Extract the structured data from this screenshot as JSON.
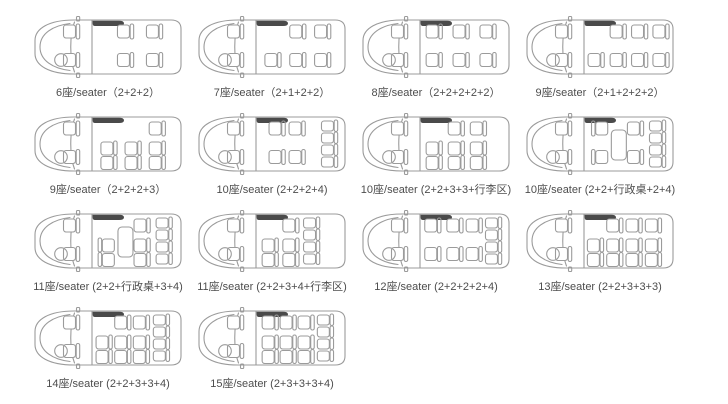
{
  "page": {
    "background": "#ffffff"
  },
  "style": {
    "line_color": "#9b9b9b",
    "dark_accent": "#4a4a4a",
    "label_color": "#4d4d4d"
  },
  "rows": [
    [
      0,
      1,
      2,
      3
    ],
    [
      4,
      5,
      6,
      7
    ],
    [
      8,
      9,
      10,
      11
    ],
    [
      12,
      13
    ]
  ],
  "vans": [
    {
      "seats_total": 6,
      "config": "2+2+2",
      "label": "6座/seater（2+2+2）",
      "layout": {
        "items": [
          {
            "t": "seat",
            "x": 0.34,
            "r": "top"
          },
          {
            "t": "seat",
            "x": 0.34,
            "r": "bottom"
          },
          {
            "t": "seat",
            "x": 0.76,
            "r": "top"
          },
          {
            "t": "seat",
            "x": 0.76,
            "r": "bottom"
          }
        ]
      }
    },
    {
      "seats_total": 7,
      "config": "2+1+2+2",
      "label": "7座/seater（2+1+2+2）",
      "layout": {
        "items": [
          {
            "t": "seat",
            "x": 0.1,
            "r": "bottom"
          },
          {
            "t": "seat",
            "x": 0.46,
            "r": "top"
          },
          {
            "t": "seat",
            "x": 0.46,
            "r": "bottom"
          },
          {
            "t": "seat",
            "x": 0.82,
            "r": "top"
          },
          {
            "t": "seat",
            "x": 0.82,
            "r": "bottom"
          }
        ]
      }
    },
    {
      "seats_total": 8,
      "config": "2+2+2+2+2",
      "label": "8座/seater（2+2+2+2+2）",
      "layout": {
        "items": [
          {
            "t": "seat",
            "x": 0.06,
            "r": "top"
          },
          {
            "t": "seat",
            "x": 0.06,
            "r": "bottom"
          },
          {
            "t": "seat",
            "x": 0.45,
            "r": "top"
          },
          {
            "t": "seat",
            "x": 0.45,
            "r": "bottom"
          },
          {
            "t": "seat",
            "x": 0.84,
            "r": "top"
          },
          {
            "t": "seat",
            "x": 0.84,
            "r": "bottom"
          }
        ]
      }
    },
    {
      "seats_total": 9,
      "config": "2+1+2+2+2",
      "label": "9座/seater（2+1+2+2+2）",
      "layout": {
        "items": [
          {
            "t": "seat",
            "x": 0.03,
            "r": "bottom"
          },
          {
            "t": "seat",
            "x": 0.35,
            "r": "top"
          },
          {
            "t": "seat",
            "x": 0.35,
            "r": "bottom"
          },
          {
            "t": "seat",
            "x": 0.66,
            "r": "top"
          },
          {
            "t": "seat",
            "x": 0.66,
            "r": "bottom"
          },
          {
            "t": "seat",
            "x": 0.97,
            "r": "top"
          },
          {
            "t": "seat",
            "x": 0.97,
            "r": "bottom"
          }
        ]
      }
    },
    {
      "seats_total": 9,
      "config": "2+2+2+3",
      "label": "9座/seater（2+2+2+3）",
      "layout": {
        "items": [
          {
            "t": "bench2",
            "x": 0.1
          },
          {
            "t": "bench2",
            "x": 0.45
          },
          {
            "t": "bench2",
            "x": 0.8
          },
          {
            "t": "seat",
            "x": 0.8,
            "r": "top"
          }
        ]
      }
    },
    {
      "seats_total": 10,
      "config": "2+2+2+4",
      "label": "10座/seater (2+2+2+4)",
      "layout": {
        "items": [
          {
            "t": "seat",
            "x": 0.16,
            "r": "top"
          },
          {
            "t": "seat",
            "x": 0.16,
            "r": "bottom"
          },
          {
            "t": "seat",
            "x": 0.45,
            "r": "top"
          },
          {
            "t": "seat",
            "x": 0.45,
            "r": "bottom"
          },
          {
            "t": "bench4",
            "x": 0.92
          }
        ]
      }
    },
    {
      "seats_total": 10,
      "config": "2+2+3+3+行李区",
      "label": "10座/seater (2+2+3+3+行李区)",
      "layout": {
        "items": [
          {
            "t": "bench2",
            "x": 0.06
          },
          {
            "t": "bench2",
            "x": 0.38
          },
          {
            "t": "seat",
            "x": 0.38,
            "r": "top"
          },
          {
            "t": "bench2",
            "x": 0.7
          },
          {
            "t": "seat",
            "x": 0.7,
            "r": "top"
          }
        ]
      }
    },
    {
      "seats_total": 10,
      "config": "2+2+行政桌+2+4",
      "label": "10座/seater (2+2+行政桌+2+4)",
      "layout": {
        "items": [
          {
            "t": "seat",
            "x": 0.08,
            "r": "top",
            "flip": true
          },
          {
            "t": "seat",
            "x": 0.08,
            "r": "bottom",
            "flip": true
          },
          {
            "t": "table",
            "x": 0.36
          },
          {
            "t": "seat",
            "x": 0.6,
            "r": "top"
          },
          {
            "t": "seat",
            "x": 0.6,
            "r": "bottom"
          },
          {
            "t": "bench4",
            "x": 0.92
          }
        ]
      }
    },
    {
      "seats_total": 11,
      "config": "2+2+行政桌+3+4",
      "label": "11座/seater (2+2+行政桌+3+4)",
      "layout": {
        "items": [
          {
            "t": "bench2",
            "x": 0.06,
            "flip": true
          },
          {
            "t": "table",
            "x": 0.34
          },
          {
            "t": "seat",
            "x": 0.58,
            "r": "top"
          },
          {
            "t": "bench2",
            "x": 0.58
          },
          {
            "t": "bench4",
            "x": 0.9
          }
        ]
      }
    },
    {
      "seats_total": 11,
      "config": "2+2+3+4+行李区",
      "label": "11座/seater (2+2+3+4+行李区)",
      "layout": {
        "items": [
          {
            "t": "bench2",
            "x": 0.06
          },
          {
            "t": "seat",
            "x": 0.36,
            "r": "top"
          },
          {
            "t": "bench2",
            "x": 0.36
          },
          {
            "t": "bench4",
            "x": 0.66
          }
        ]
      }
    },
    {
      "seats_total": 12,
      "config": "2+2+2+2+4",
      "label": "12座/seater (2+2+2+2+4)",
      "layout": {
        "items": [
          {
            "t": "seat",
            "x": 0.04,
            "r": "top"
          },
          {
            "t": "seat",
            "x": 0.04,
            "r": "bottom"
          },
          {
            "t": "seat",
            "x": 0.36,
            "r": "top"
          },
          {
            "t": "seat",
            "x": 0.36,
            "r": "bottom"
          },
          {
            "t": "seat",
            "x": 0.64,
            "r": "top"
          },
          {
            "t": "seat",
            "x": 0.64,
            "r": "bottom"
          },
          {
            "t": "bench4",
            "x": 0.92
          }
        ]
      }
    },
    {
      "seats_total": 13,
      "config": "2+2+3+3+3",
      "label": "13座/seater (2+2+3+3+3)",
      "layout": {
        "items": [
          {
            "t": "bench2",
            "x": 0.02
          },
          {
            "t": "bench2",
            "x": 0.3
          },
          {
            "t": "seat",
            "x": 0.3,
            "r": "top"
          },
          {
            "t": "bench2",
            "x": 0.58
          },
          {
            "t": "seat",
            "x": 0.58,
            "r": "top"
          },
          {
            "t": "bench2",
            "x": 0.86
          },
          {
            "t": "seat",
            "x": 0.86,
            "r": "top"
          }
        ]
      }
    },
    {
      "seats_total": 14,
      "config": "2+2+3+3+4",
      "label": "14座/seater (2+2+3+3+4)",
      "layout": {
        "items": [
          {
            "t": "bench2",
            "x": 0.03
          },
          {
            "t": "bench2",
            "x": 0.3
          },
          {
            "t": "seat",
            "x": 0.3,
            "r": "top"
          },
          {
            "t": "bench2",
            "x": 0.57
          },
          {
            "t": "seat",
            "x": 0.57,
            "r": "top"
          },
          {
            "t": "bench4",
            "x": 0.86
          }
        ]
      }
    },
    {
      "seats_total": 15,
      "config": "2+3+3+3+4",
      "label": "15座/seater (2+3+3+3+4)",
      "layout": {
        "items": [
          {
            "t": "bench2",
            "x": 0.06
          },
          {
            "t": "seat",
            "x": 0.06,
            "r": "top"
          },
          {
            "t": "bench2",
            "x": 0.32
          },
          {
            "t": "seat",
            "x": 0.32,
            "r": "top"
          },
          {
            "t": "bench2",
            "x": 0.58
          },
          {
            "t": "seat",
            "x": 0.58,
            "r": "top"
          },
          {
            "t": "bench4",
            "x": 0.86
          }
        ]
      }
    }
  ]
}
